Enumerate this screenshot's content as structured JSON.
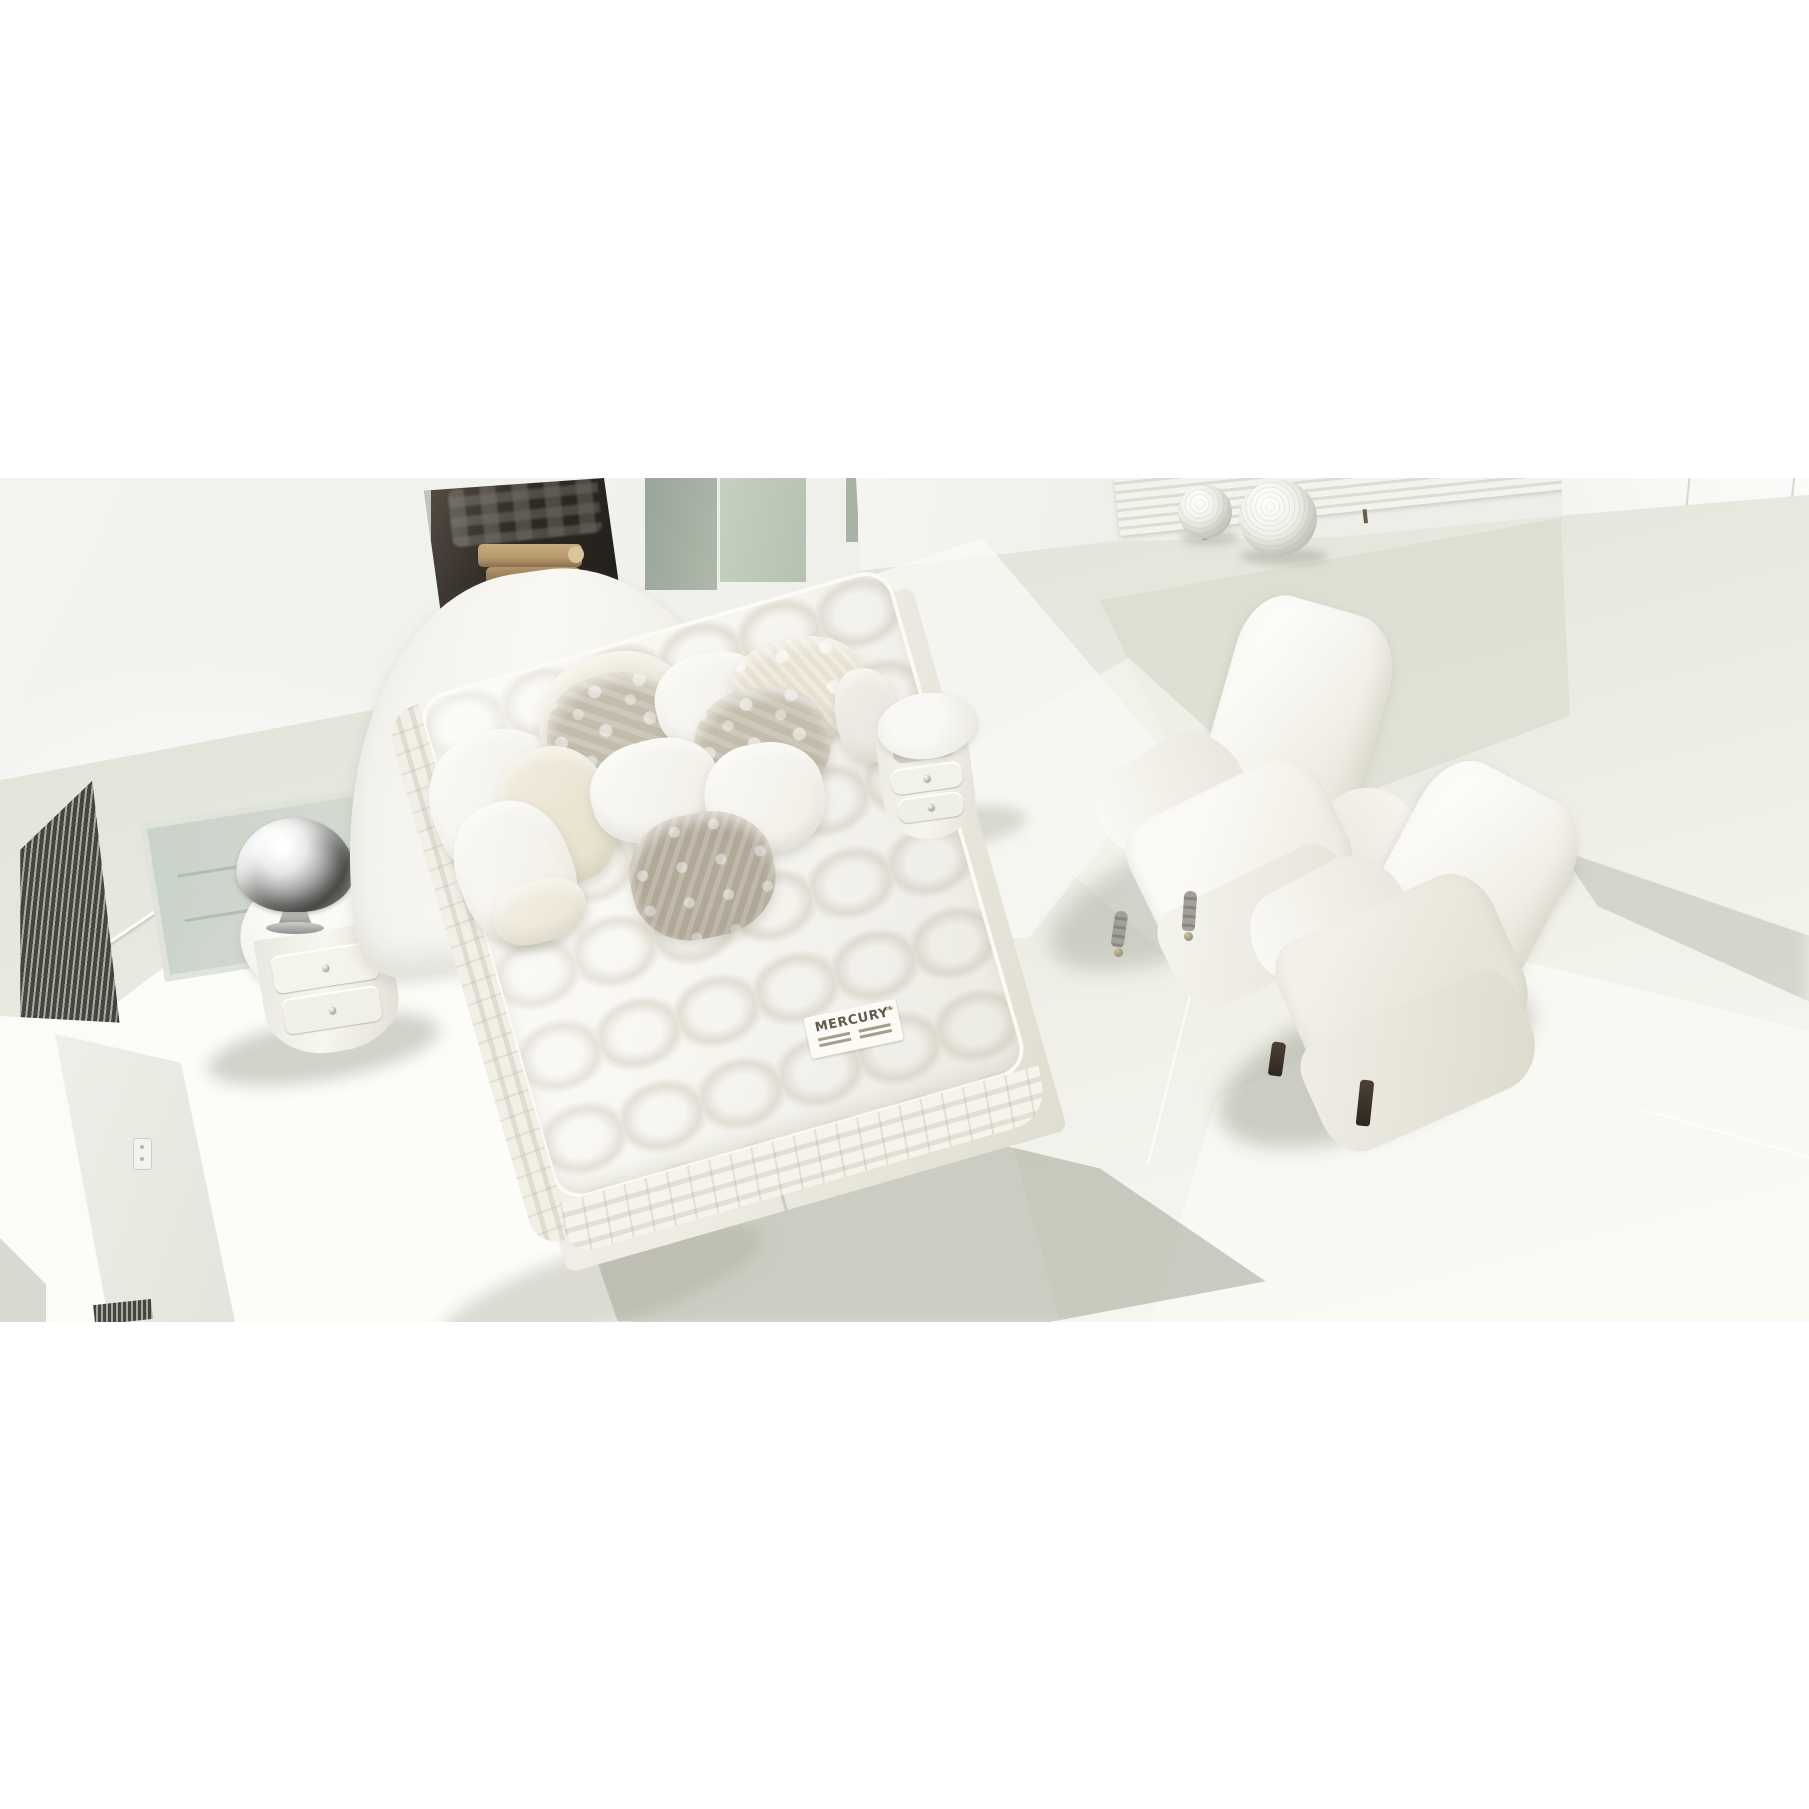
{
  "window": {
    "background": "#ffffff"
  },
  "photo": {
    "kind": "interior-photograph",
    "subject": "All-white bedroom seen from above: upholstered bed with curved headboard, pile of white/cream/taupe damask pillows, thick tufted MERCURY mattress on a fabric base, two round bedside cabinets with crystal knobs, ornate silver bowl, fireplace niche with stacked logs, green glass partition, floor vent grille, glass floor inset, two decorative textured spheres, wall radiator, glossy paneled wardrobe and two white armchairs (one on turned casters, one on dark wooden legs)",
    "mattress_label": {
      "brand": "MERCURY",
      "laurel_icon": "❧"
    },
    "objects": [
      "floor-vent-grille",
      "glass-floor-panel",
      "round-nightstand-left",
      "silver-bowl",
      "upholstered-headboard",
      "decor-pillows",
      "tufted-mattress",
      "mattress-brand-label",
      "bed-base",
      "round-nightstand-right",
      "fireplace-niche-with-logs",
      "glass-partition",
      "white-wall-block",
      "decor-spheres",
      "wall-radiator",
      "glossy-wardrobe",
      "armchair-with-casters",
      "armchair-with-dark-legs",
      "light-switch"
    ],
    "colors": {
      "wall": "#eff0ea",
      "floor": "#dfe1d5",
      "floor_bright": "#f9f9f5",
      "platform": "#fcfcf9",
      "grille_dark": "#45453f",
      "grille_light": "#a9a9a1",
      "niche_dark": "#2e2a24",
      "frame_metal": "#cfd0ca",
      "wood": "#b69a6f",
      "wood_dark": "#7d6344",
      "glass_green": "#99a597",
      "glass_green_light": "#c6cfc0",
      "glass_floor_a": "#c9d2c9",
      "glass_floor_b": "#c3ccc2",
      "mattress": "#f8f7f2",
      "mattress_dimple": "#e3e0d5",
      "bed_base": "#edebe2",
      "pillow_cream": "#ebe6d6",
      "pillow_taupe": "#c3bcab",
      "pillow_gray": "#b1a897",
      "silver_hi": "#e9eae8",
      "silver_mid": "#9b9d9a",
      "silver_deep": "#5c5d5a",
      "leg_dark": "#2f2820",
      "wardrobe": "#f6f6f2",
      "seam": "#d7d8cf",
      "label_ink": "#5f5a4a",
      "label_gold": "#9a8a55"
    }
  }
}
